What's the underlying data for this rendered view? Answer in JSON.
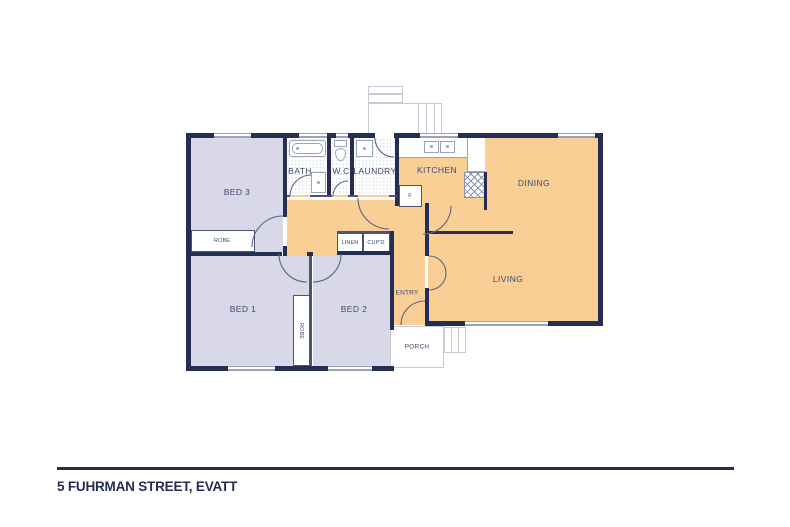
{
  "title": "5 FUHRMAN STREET, EVATT",
  "rooms": {
    "bed1": "BED 1",
    "bed2": "BED 2",
    "bed3": "BED 3",
    "bath": "BATH",
    "wc": "W.C",
    "laundry": "LAUNDRY",
    "kitchen": "KITCHEN",
    "dining": "DINING",
    "living": "LIVING",
    "entry": "ENTRY",
    "porch": "PORCH"
  },
  "storage": {
    "robe_bed3": "ROBE",
    "robe_beds12": "ROBE",
    "linen": "LINEN",
    "cupboard": "CUP'D",
    "fridge": "F"
  },
  "colors": {
    "wall": "#232e52",
    "bedroom_fill": "#d8d8e8",
    "living_fill": "#f9cf96",
    "window_frame": "#9aa3bb",
    "outline_gray": "#c6cbd8",
    "label_text": "#3d4a6e",
    "title_text": "#232e52"
  }
}
